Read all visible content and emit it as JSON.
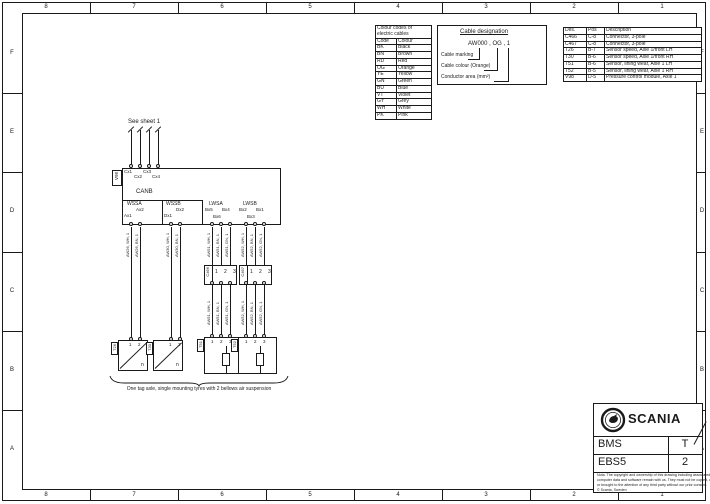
{
  "frame": {
    "columns": [
      "8",
      "7",
      "6",
      "5",
      "4",
      "3",
      "2",
      "1"
    ],
    "rows": [
      "F",
      "E",
      "D",
      "C",
      "B",
      "A"
    ]
  },
  "color_table": {
    "title_line1": "Colour codes of",
    "title_line2": "electric cables",
    "header": {
      "code": "Code",
      "colour": "Colour"
    },
    "rows": [
      {
        "code": "BK",
        "colour": "Black"
      },
      {
        "code": "BN",
        "colour": "Brown"
      },
      {
        "code": "RD",
        "colour": "Red"
      },
      {
        "code": "OG",
        "colour": "Orange"
      },
      {
        "code": "YE",
        "colour": "Yellow"
      },
      {
        "code": "GN",
        "colour": "Green"
      },
      {
        "code": "BU",
        "colour": "Blue"
      },
      {
        "code": "VT",
        "colour": "Violet"
      },
      {
        "code": "GY",
        "colour": "Grey"
      },
      {
        "code": "WH",
        "colour": "White"
      },
      {
        "code": "PK",
        "colour": "Pink"
      }
    ]
  },
  "cable_designation": {
    "title": "Cable designation",
    "example": "AW000 , OG , 1",
    "labels": [
      "Cable marking",
      "Cable colour (Orange)",
      "Conductor area (mm²)"
    ]
  },
  "parts_table": {
    "headers": [
      "Des.",
      "Pos",
      "Description"
    ],
    "rows": [
      [
        "C466",
        "C-8",
        "Connector, 3-pole"
      ],
      [
        "C467",
        "C-8",
        "Connector, 3-pole"
      ],
      [
        "T26",
        "B-7",
        "Sensor speed, Axle 1/front LH"
      ],
      [
        "T30",
        "B-6",
        "Sensor speed, Axle 1/front RH"
      ],
      [
        "T51",
        "B-6",
        "Sensor, lining wear, Axle 1 LH"
      ],
      [
        "T52",
        "B-5",
        "Sensor, lining wear, Axle 1 RH"
      ],
      [
        "V98",
        "D-5",
        "Pressure control module, Axle 1"
      ]
    ]
  },
  "module": {
    "ref": "V98",
    "see_sheet": "See sheet 1",
    "can_label": "CANB",
    "can_pins": [
      "Cx1",
      "Cx2",
      "Cx3",
      "Cx4"
    ],
    "wssa": {
      "label": "WSSA",
      "pin1": "Ax1",
      "pin2": "Ax2"
    },
    "wssb": {
      "label": "WSSB",
      "pin1": "Dx1",
      "pin2": "Dx2"
    },
    "lwsa": {
      "label": "LWSA",
      "pin1": "Bx5",
      "pin2": "Bx4",
      "pin3": "Bx6"
    },
    "lwsb": {
      "label": "LWSB",
      "pin1": "Bx2",
      "pin2": "Bx1",
      "pin3": "Bx3"
    }
  },
  "wire_labels": {
    "wssa": [
      "AW26, WH, 1",
      "AW26, BN, 1"
    ],
    "wssb": [
      "AW30, WH, 1",
      "AW30, BN, 1"
    ],
    "lwsa_upper": [
      "AW51, WH, 1",
      "AW51, BN, 1",
      "AW51, GN, 1"
    ],
    "lwsb_upper": [
      "AW52, WH, 1",
      "AW52, BN, 1",
      "AW52, GN, 1"
    ],
    "lwsa_lower": [
      "AW51, WH, 1",
      "AW51, BN, 1",
      "AW51, GN, 1"
    ],
    "lwsb_lower": [
      "AW52, WH, 1",
      "AW52, BN, 1",
      "AW52, GN, 1"
    ]
  },
  "connectors": {
    "c466": {
      "ref": "C466",
      "pins": [
        "1",
        "2",
        "3"
      ]
    },
    "c467": {
      "ref": "C467",
      "pins": [
        "1",
        "2",
        "3"
      ]
    }
  },
  "sensors": {
    "t26": {
      "ref": "T26",
      "pin1": "1",
      "pin2": "2",
      "symbol": "n"
    },
    "t30": {
      "ref": "T30",
      "pin1": "1",
      "pin2": "2",
      "symbol": "n"
    },
    "t51": {
      "ref": "T51",
      "pin1": "1",
      "pin2": "2",
      "pin3": "3"
    },
    "t52": {
      "ref": "T52",
      "pin1": "1",
      "pin2": "2",
      "pin3": "3"
    }
  },
  "caption": "One tag axle, single mounting tyres with 2 bellows air suspension",
  "title_block": {
    "brand": "SCANIA",
    "row1_left": "BMS",
    "row1_right": "T",
    "row2_left": "EBS5",
    "row2_right": "2",
    "fine_print": [
      "Nota. The copyright and ownership of this drawing including associated",
      "computer data and software remain with us. They must not be copied, used,",
      "or brought to the attention of any third party without our prior consent.",
      "© Scania, Sweden"
    ]
  }
}
